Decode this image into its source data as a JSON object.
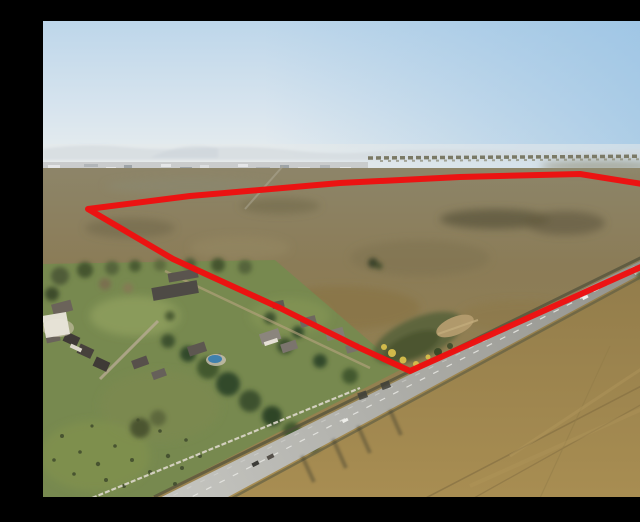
{
  "scene": {
    "description": "Aerial drone photograph of a large vacant grassland development parcel outlined with a thick red boundary line, bordered by a diagonal two-lane road on the lower right, a residential estate with trees, houses and a swimming pool on the lower left, and a hazy horizon with a distant town strip under a pale blue sky"
  },
  "frame": {
    "letterbox_color": "#000000",
    "photo_area": {
      "x": 3,
      "y": 5,
      "w": 632,
      "h": 476
    }
  },
  "boundary": {
    "color": "#ee0f0f",
    "stroke_width": 6,
    "points": [
      [
        48,
        193
      ],
      [
        150,
        180
      ],
      [
        300,
        167
      ],
      [
        420,
        161
      ],
      [
        540,
        158
      ],
      [
        652,
        176
      ],
      [
        652,
        228
      ],
      [
        370,
        355
      ],
      [
        320,
        332
      ],
      [
        240,
        292
      ],
      [
        133,
        243
      ]
    ]
  },
  "palette": {
    "letterbox": "#000000",
    "sky_top": "#bdd6ea",
    "sky_mid": "#d7e4ee",
    "sky_horizon": "#edf0ef",
    "sky_right_blue": "#8fbde2",
    "hills": "#b7c1cb",
    "haze": "#e6eaea",
    "city_strip": "#c6c9c9",
    "city_light": "#e8e9ea",
    "city_dark": "#9aa0a3",
    "treeline": "#6b6850",
    "field_far": "#8d8569",
    "field_mid": "#8b7c57",
    "field_warm": "#94804f",
    "field_dark": "#5e573d",
    "gold_near": "#a98e52",
    "gold_far": "#8f7a4a",
    "track": "#8a7445",
    "road_near": "#c6c6c1",
    "road_far": "#8e8e88",
    "lane_mark": "#e9e9e5",
    "shoulder_dark": "#4f4f3a",
    "lawn": "#77894f",
    "lawn_light": "#93a35f",
    "tree_dark": "#33492a",
    "tree_mid": "#42592f",
    "tree_olive": "#55633a",
    "roof_dark": "#4e4a45",
    "roof_gray": "#7b746c",
    "wall_white": "#ddd8cc",
    "pool_blue": "#3f80ad",
    "marsh": "#55603a",
    "dirt": "#b49c6e",
    "bush_yellow": "#d8bf4c"
  }
}
